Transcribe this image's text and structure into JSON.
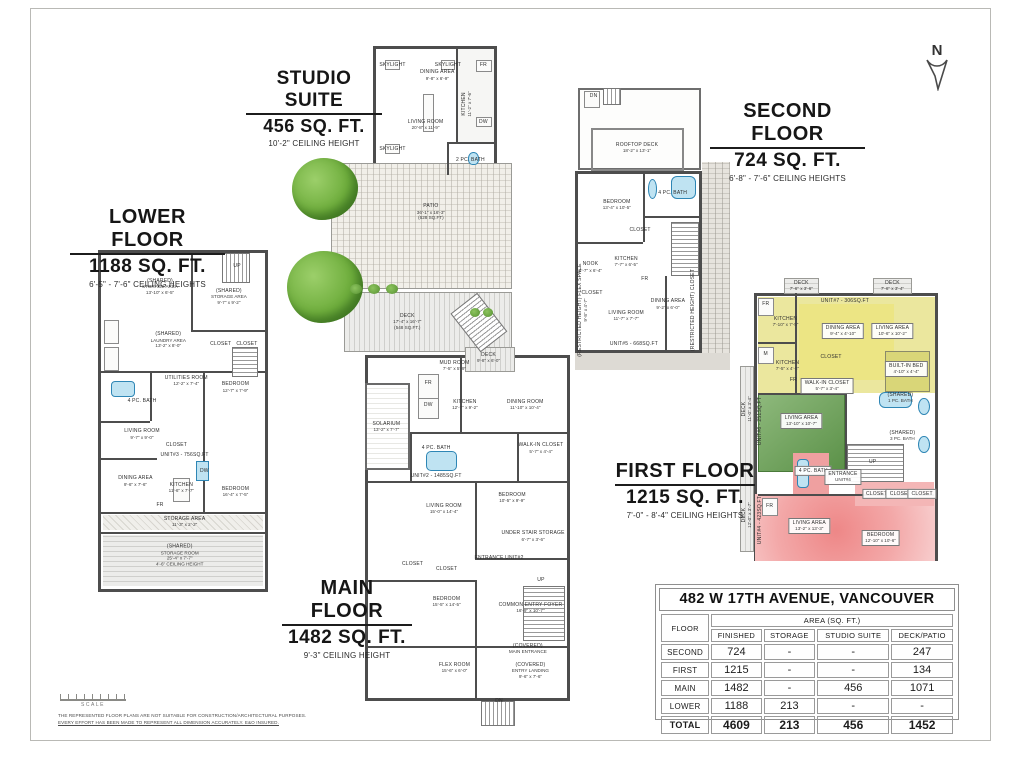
{
  "page": {
    "north_label": "N",
    "scale_label": "SCALE",
    "disclaimer1": "THE REPRESENTED FLOOR PLANS ARE NOT SUITABLE FOR CONSTRUCTION/ARCHITECTURAL PURPOSES.",
    "disclaimer2": "EVERY EFFORT HAS BEEN MADE TO REPRESENT ALL DIMENSION ACCURATELY. E&O INSURED."
  },
  "colors": {
    "unit_yellow": "#ebe79e",
    "unit_green": "#6fa35c",
    "unit_red": "#ee8787",
    "fixture_blue": "#bfe3f2",
    "wall_gray": "#4d4d4d"
  },
  "titles": {
    "studio": {
      "name": "STUDIO SUITE",
      "area": "456 SQ. FT.",
      "ceiling": "10'-2\" CEILING HEIGHT"
    },
    "second": {
      "name": "SECOND FLOOR",
      "area": "724 SQ. FT.",
      "ceiling": "6'-8\" - 7'-6\" CEILING HEIGHTS"
    },
    "lower": {
      "name": "LOWER FLOOR",
      "area": "1188 SQ. FT.",
      "ceiling": "6'-5\" - 7'-6\" CEILING HEIGHTS"
    },
    "main": {
      "name": "MAIN FLOOR",
      "area": "1482 SQ. FT.",
      "ceiling": "9'-3\" CEILING HEIGHT"
    },
    "first": {
      "name": "FIRST FLOOR",
      "area": "1215 SQ. FT.",
      "ceiling": "7'-0\" - 8'-4\" CEILING HEIGHTS"
    }
  },
  "plans": {
    "studio": {
      "rooms": [
        {
          "n": "SKYLIGHT",
          "x": 14,
          "y": 13
        },
        {
          "n": "SKYLIGHT",
          "x": 14,
          "y": 79
        },
        {
          "n": "SKYLIGHT",
          "x": 61,
          "y": 13
        },
        {
          "n": "DINING AREA",
          "d": "9'-8\" x 6'-9\"",
          "x": 52,
          "y": 21
        },
        {
          "n": "LIVING ROOM",
          "d": "20'-8\" x 11'-9\"",
          "x": 42,
          "y": 60
        },
        {
          "n": "KITCHEN",
          "d": "11'-2\" x 7'-6\"",
          "x": 77,
          "y": 44,
          "v": true
        },
        {
          "n": "FR",
          "x": 91,
          "y": 13
        },
        {
          "n": "DW",
          "x": 91,
          "y": 58
        },
        {
          "n": "2 PC. BATH",
          "x": 80,
          "y": 88
        }
      ]
    },
    "second": {
      "rooms": [
        {
          "n": "DN",
          "x": 12,
          "y": 4
        },
        {
          "n": "ROOFTOP DECK",
          "d": "18'-2\" x 13'-1\"",
          "x": 40,
          "y": 22
        },
        {
          "n": "BEDROOM",
          "d": "13'-4\" x 10'-5\"",
          "x": 27,
          "y": 42
        },
        {
          "n": "4 PC. BATH",
          "x": 63,
          "y": 38
        },
        {
          "n": "CLOSET",
          "x": 42,
          "y": 51
        },
        {
          "n": "KITCHEN",
          "d": "7'-7\" x 6'-5\"",
          "x": 33,
          "y": 62
        },
        {
          "n": "NOOK",
          "d": "6'-7\" x 6'-4\"",
          "x": 10,
          "y": 64
        },
        {
          "n": "FR",
          "x": 45,
          "y": 68
        },
        {
          "n": "CLOSET",
          "x": 11,
          "y": 73
        },
        {
          "n": "LIVING ROOM",
          "d": "11'-7\" x 7'-7\"",
          "x": 33,
          "y": 81
        },
        {
          "n": "DINING AREA",
          "d": "9'-2\" x 6'-0\"",
          "x": 60,
          "y": 77
        },
        {
          "n": "(RESTRICTED HEIGHT) FLEX SPACE",
          "d": "9'-8\" x 4'-7\"",
          "x": 5,
          "y": 79,
          "v": true
        },
        {
          "n": "(RESTRICTED HEIGHT) CLOSET",
          "x": 76,
          "y": 79,
          "v": true
        },
        {
          "n": "UNIT#5 - 668SQ.FT",
          "x": 38,
          "y": 91
        }
      ]
    },
    "lower": {
      "rooms": [
        {
          "n": "UP",
          "x": 83,
          "y": 4
        },
        {
          "n": "(SHARED)",
          "d": "STORAGE AREA",
          "s": "13'-10\" x 6'-5\"",
          "x": 36,
          "y": 10
        },
        {
          "n": "(SHARED)",
          "d": "STORAGE AREA",
          "s": "9'-7\" x 9'-2\"",
          "x": 78,
          "y": 13
        },
        {
          "n": "(SHARED)",
          "d": "LAUNDRY AREA",
          "s": "13'-2\" x 8'-0\"",
          "x": 41,
          "y": 26
        },
        {
          "n": "CLOSET",
          "x": 73,
          "y": 27
        },
        {
          "n": "CLOSET",
          "x": 89,
          "y": 27
        },
        {
          "n": "UTILITIES ROOM",
          "d": "12'-2\" x 7'-4\"",
          "x": 52,
          "y": 38
        },
        {
          "n": "BEDROOM",
          "d": "12'-7\" x 7'-9\"",
          "x": 82,
          "y": 40
        },
        {
          "n": "4 PC. BATH",
          "x": 25,
          "y": 44
        },
        {
          "n": "LIVING ROOM",
          "d": "9'-7\" x 9'-0\"",
          "x": 25,
          "y": 54
        },
        {
          "n": "CLOSET",
          "x": 46,
          "y": 57
        },
        {
          "n": "UNIT#3 - 756SQ.FT",
          "x": 51,
          "y": 60
        },
        {
          "n": "DINING AREA",
          "d": "9'-6\" x 7'-6\"",
          "x": 21,
          "y": 68
        },
        {
          "n": "KITCHEN",
          "d": "11'-6\" x 7'-7\"",
          "x": 49,
          "y": 70
        },
        {
          "n": "DW",
          "x": 63,
          "y": 65
        },
        {
          "n": "FR",
          "x": 36,
          "y": 75
        },
        {
          "n": "BEDROOM",
          "d": "16'-4\" x 7'-5\"",
          "x": 82,
          "y": 71
        },
        {
          "n": "STORAGE AREA",
          "d": "11'-3\" x 2'-2\"",
          "x": 51,
          "y": 80
        },
        {
          "n": "(SHARED)",
          "d": "STORAGE ROOM",
          "s": "25'-4\" x 7'-7\"",
          "s2": "4'-6\" CEILING HEIGHT",
          "x": 48,
          "y": 90
        }
      ]
    },
    "main": {
      "rooms": [
        {
          "n": "PATIO",
          "d": "36'-1\" x 16'-3\"",
          "s": "(628 SQ.FT)",
          "x": 45,
          "y": 9
        },
        {
          "n": "DECK",
          "d": "17'-4\" x 16'-7\"",
          "s": "(548 SQ.FT.)",
          "x": 36,
          "y": 29
        },
        {
          "n": "DECK",
          "d": "9'-8\" x 6'-0\"",
          "x": 67,
          "y": 35.5
        },
        {
          "n": "MUD ROOM",
          "d": "7'-5\" x 5'-9\"",
          "x": 54,
          "y": 37
        },
        {
          "n": "FR",
          "x": 44,
          "y": 40
        },
        {
          "n": "DW",
          "x": 44,
          "y": 44
        },
        {
          "n": "KITCHEN",
          "d": "12'-7\" x 9'-2\"",
          "x": 58,
          "y": 44
        },
        {
          "n": "DINING ROOM",
          "d": "11'-10\" x 10'-4\"",
          "x": 81,
          "y": 44
        },
        {
          "n": "SOLARIUM",
          "d": "13'-2\" x 7'-7\"",
          "x": 28,
          "y": 48
        },
        {
          "n": "4 PC. BATH",
          "x": 47,
          "y": 52
        },
        {
          "n": "WALK-IN CLOSET",
          "d": "5'-7\" x 4'-4\"",
          "x": 87,
          "y": 52
        },
        {
          "n": "UNIT#2 - 1485SQ.FT",
          "x": 47,
          "y": 57
        },
        {
          "n": "LIVING ROOM",
          "d": "15'-0\" x 14'-4\"",
          "x": 50,
          "y": 63
        },
        {
          "n": "BEDROOM",
          "d": "10'-5\" x 9'-9\"",
          "x": 76,
          "y": 61
        },
        {
          "n": "UNDER STAIR STORAGE",
          "d": "6'-7\" x 3'-6\"",
          "x": 84,
          "y": 68
        },
        {
          "n": "ENTRANCE UNIT#2",
          "x": 71,
          "y": 72
        },
        {
          "n": "CLOSET",
          "x": 38,
          "y": 73
        },
        {
          "n": "CLOSET",
          "x": 51,
          "y": 74
        },
        {
          "n": "BEDROOM",
          "d": "15'-5\" x 14'-5\"",
          "x": 51,
          "y": 80
        },
        {
          "n": "UP",
          "x": 87,
          "y": 76
        },
        {
          "n": "COMMON ENTRY FOYER",
          "d": "16'-9\" x 10'-7\"",
          "x": 83,
          "y": 81
        },
        {
          "n": "(COVERED)",
          "d": "MAIN ENTRANCE",
          "x": 82,
          "y": 88.5
        },
        {
          "n": "(COVERED)",
          "d": "ENTRY LANDING",
          "s": "9'-6\" x 7'-6\"",
          "x": 83,
          "y": 92.5
        },
        {
          "n": "FLEX ROOM",
          "d": "15'-6\" x 6'-0\"",
          "x": 54,
          "y": 92
        },
        {
          "n": "DN",
          "x": 71,
          "y": 98
        }
      ]
    },
    "first": {
      "rooms": [
        {
          "n": "DECK",
          "d": "7'-6\" x 3'-6\"",
          "x": 31,
          "y": 2.8
        },
        {
          "n": "DECK",
          "d": "7'-6\" x 3'-4\"",
          "x": 77,
          "y": 2.8
        },
        {
          "n": "UNIT#7 - 306SQ.FT",
          "x": 53,
          "y": 8
        },
        {
          "n": "KITCHEN",
          "d": "7'-10\" x 7'-5\"",
          "x": 23,
          "y": 15
        },
        {
          "n": "FR",
          "x": 13,
          "y": 9
        },
        {
          "n": "DINING AREA",
          "d": "9'-4\" x 4'-10\"",
          "x": 52,
          "y": 18,
          "b": true
        },
        {
          "n": "LIVING AREA",
          "d": "10'-6\" x 10'-2\"",
          "x": 77,
          "y": 18,
          "b": true
        },
        {
          "n": "M",
          "x": 13,
          "y": 26
        },
        {
          "n": "KITCHEN",
          "d": "7'-5\" x 4'-8\"",
          "x": 24,
          "y": 30
        },
        {
          "n": "CLOSET",
          "x": 46,
          "y": 27
        },
        {
          "n": "BUILT-IN BED",
          "d": "4'-10\" x 4'-4\"",
          "x": 84,
          "y": 31,
          "b": true
        },
        {
          "n": "FR",
          "x": 27,
          "y": 35
        },
        {
          "n": "WALK-IN CLOSET",
          "d": "5'-7\" x 3'-4\"",
          "x": 44,
          "y": 37,
          "b": true
        },
        {
          "n": "(SHARED)",
          "d": "1 PC. BATH",
          "x": 81,
          "y": 41
        },
        {
          "n": "DECK",
          "d": "11'-0\" x 3'-4\"",
          "x": 3.5,
          "y": 45,
          "v": true
        },
        {
          "n": "LIVING AREA",
          "d": "13'-10\" x 10'-7\"",
          "x": 31,
          "y": 49,
          "b": true
        },
        {
          "n": "UNIT#6 - 251SQ.FT",
          "x": 10,
          "y": 49,
          "v": true
        },
        {
          "n": "(SHARED)",
          "d": "3 PC. BATH",
          "x": 82,
          "y": 54
        },
        {
          "n": "4 PC. BATH",
          "x": 37,
          "y": 66,
          "b": true
        },
        {
          "n": "ENTRANCE",
          "d": "UNIT#4",
          "x": 52,
          "y": 68,
          "b": true
        },
        {
          "n": "UP",
          "x": 67,
          "y": 63
        },
        {
          "n": "CLOSET",
          "x": 69,
          "y": 74,
          "b": true
        },
        {
          "n": "CLOSET",
          "x": 81,
          "y": 74,
          "b": true
        },
        {
          "n": "CLOSET",
          "x": 92,
          "y": 74,
          "b": true
        },
        {
          "n": "FR",
          "x": 15,
          "y": 78
        },
        {
          "n": "DECK",
          "d": "12'-0\" x 3'-7\"",
          "x": 3.5,
          "y": 81,
          "v": true
        },
        {
          "n": "UNIT#4 - 423SQ.FT",
          "x": 10,
          "y": 83,
          "v": true
        },
        {
          "n": "LIVING AREA",
          "d": "13'-2\" x 13'-3\"",
          "x": 35,
          "y": 85,
          "b": true
        },
        {
          "n": "BEDROOM",
          "d": "12'-10\" x 10'-6\"",
          "x": 71,
          "y": 89,
          "b": true
        }
      ]
    }
  },
  "table": {
    "title": "482 W 17TH AVENUE, VANCOUVER",
    "floor_header": "FLOOR",
    "area_header": "AREA (SQ. FT.)",
    "columns": [
      "FINISHED",
      "STORAGE",
      "STUDIO SUITE",
      "DECK/PATIO"
    ],
    "rows": [
      {
        "floor": "SECOND",
        "values": [
          "724",
          "-",
          "-",
          "247"
        ]
      },
      {
        "floor": "FIRST",
        "values": [
          "1215",
          "-",
          "-",
          "134"
        ]
      },
      {
        "floor": "MAIN",
        "values": [
          "1482",
          "-",
          "456",
          "1071"
        ]
      },
      {
        "floor": "LOWER",
        "values": [
          "1188",
          "213",
          "-",
          "-"
        ]
      },
      {
        "floor": "TOTAL",
        "values": [
          "4609",
          "213",
          "456",
          "1452"
        ],
        "total": true
      }
    ]
  }
}
